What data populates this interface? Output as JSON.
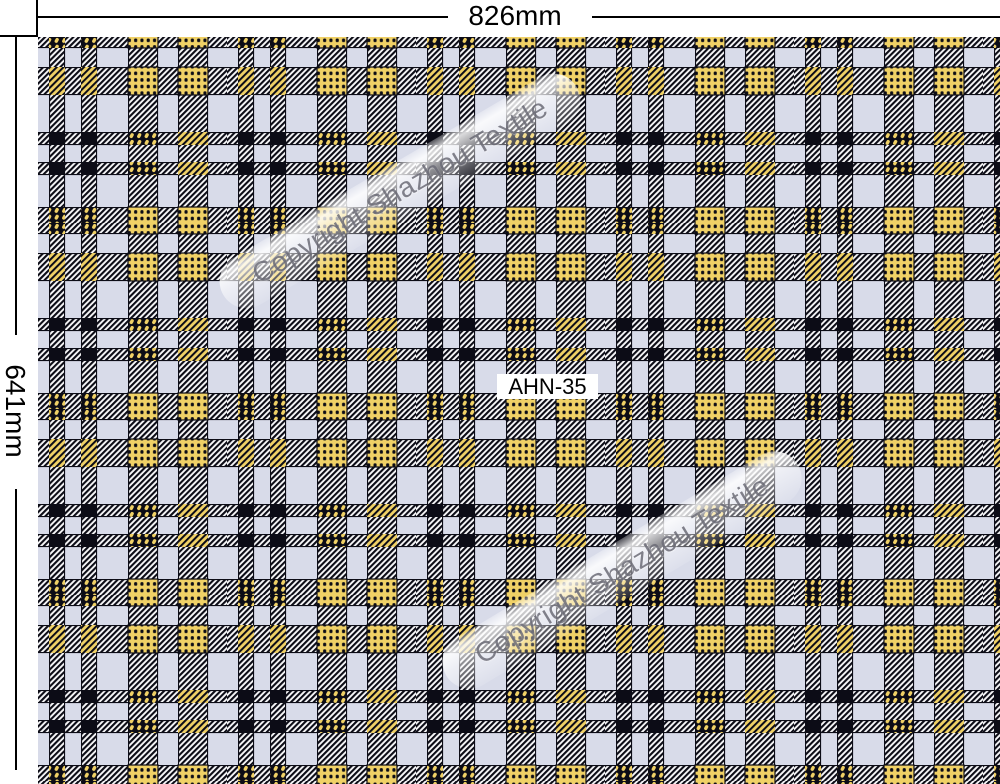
{
  "dimension_annotations": {
    "width_label": "826mm",
    "height_label": "641mm"
  },
  "fabric": {
    "code_label": "AHN-35"
  },
  "watermark": {
    "text": "Copyright Shazhou Textile"
  },
  "colors": {
    "page_background": "#ffffff",
    "fabric_background": "#d8dbe9",
    "hatch_light": "#f8f8fa",
    "ink": "#0c0c16",
    "accent_yellow": "#f0d166",
    "dimension_line": "#000000",
    "watermark_text": "#6d6d78",
    "label_background": "#ffffff"
  }
}
